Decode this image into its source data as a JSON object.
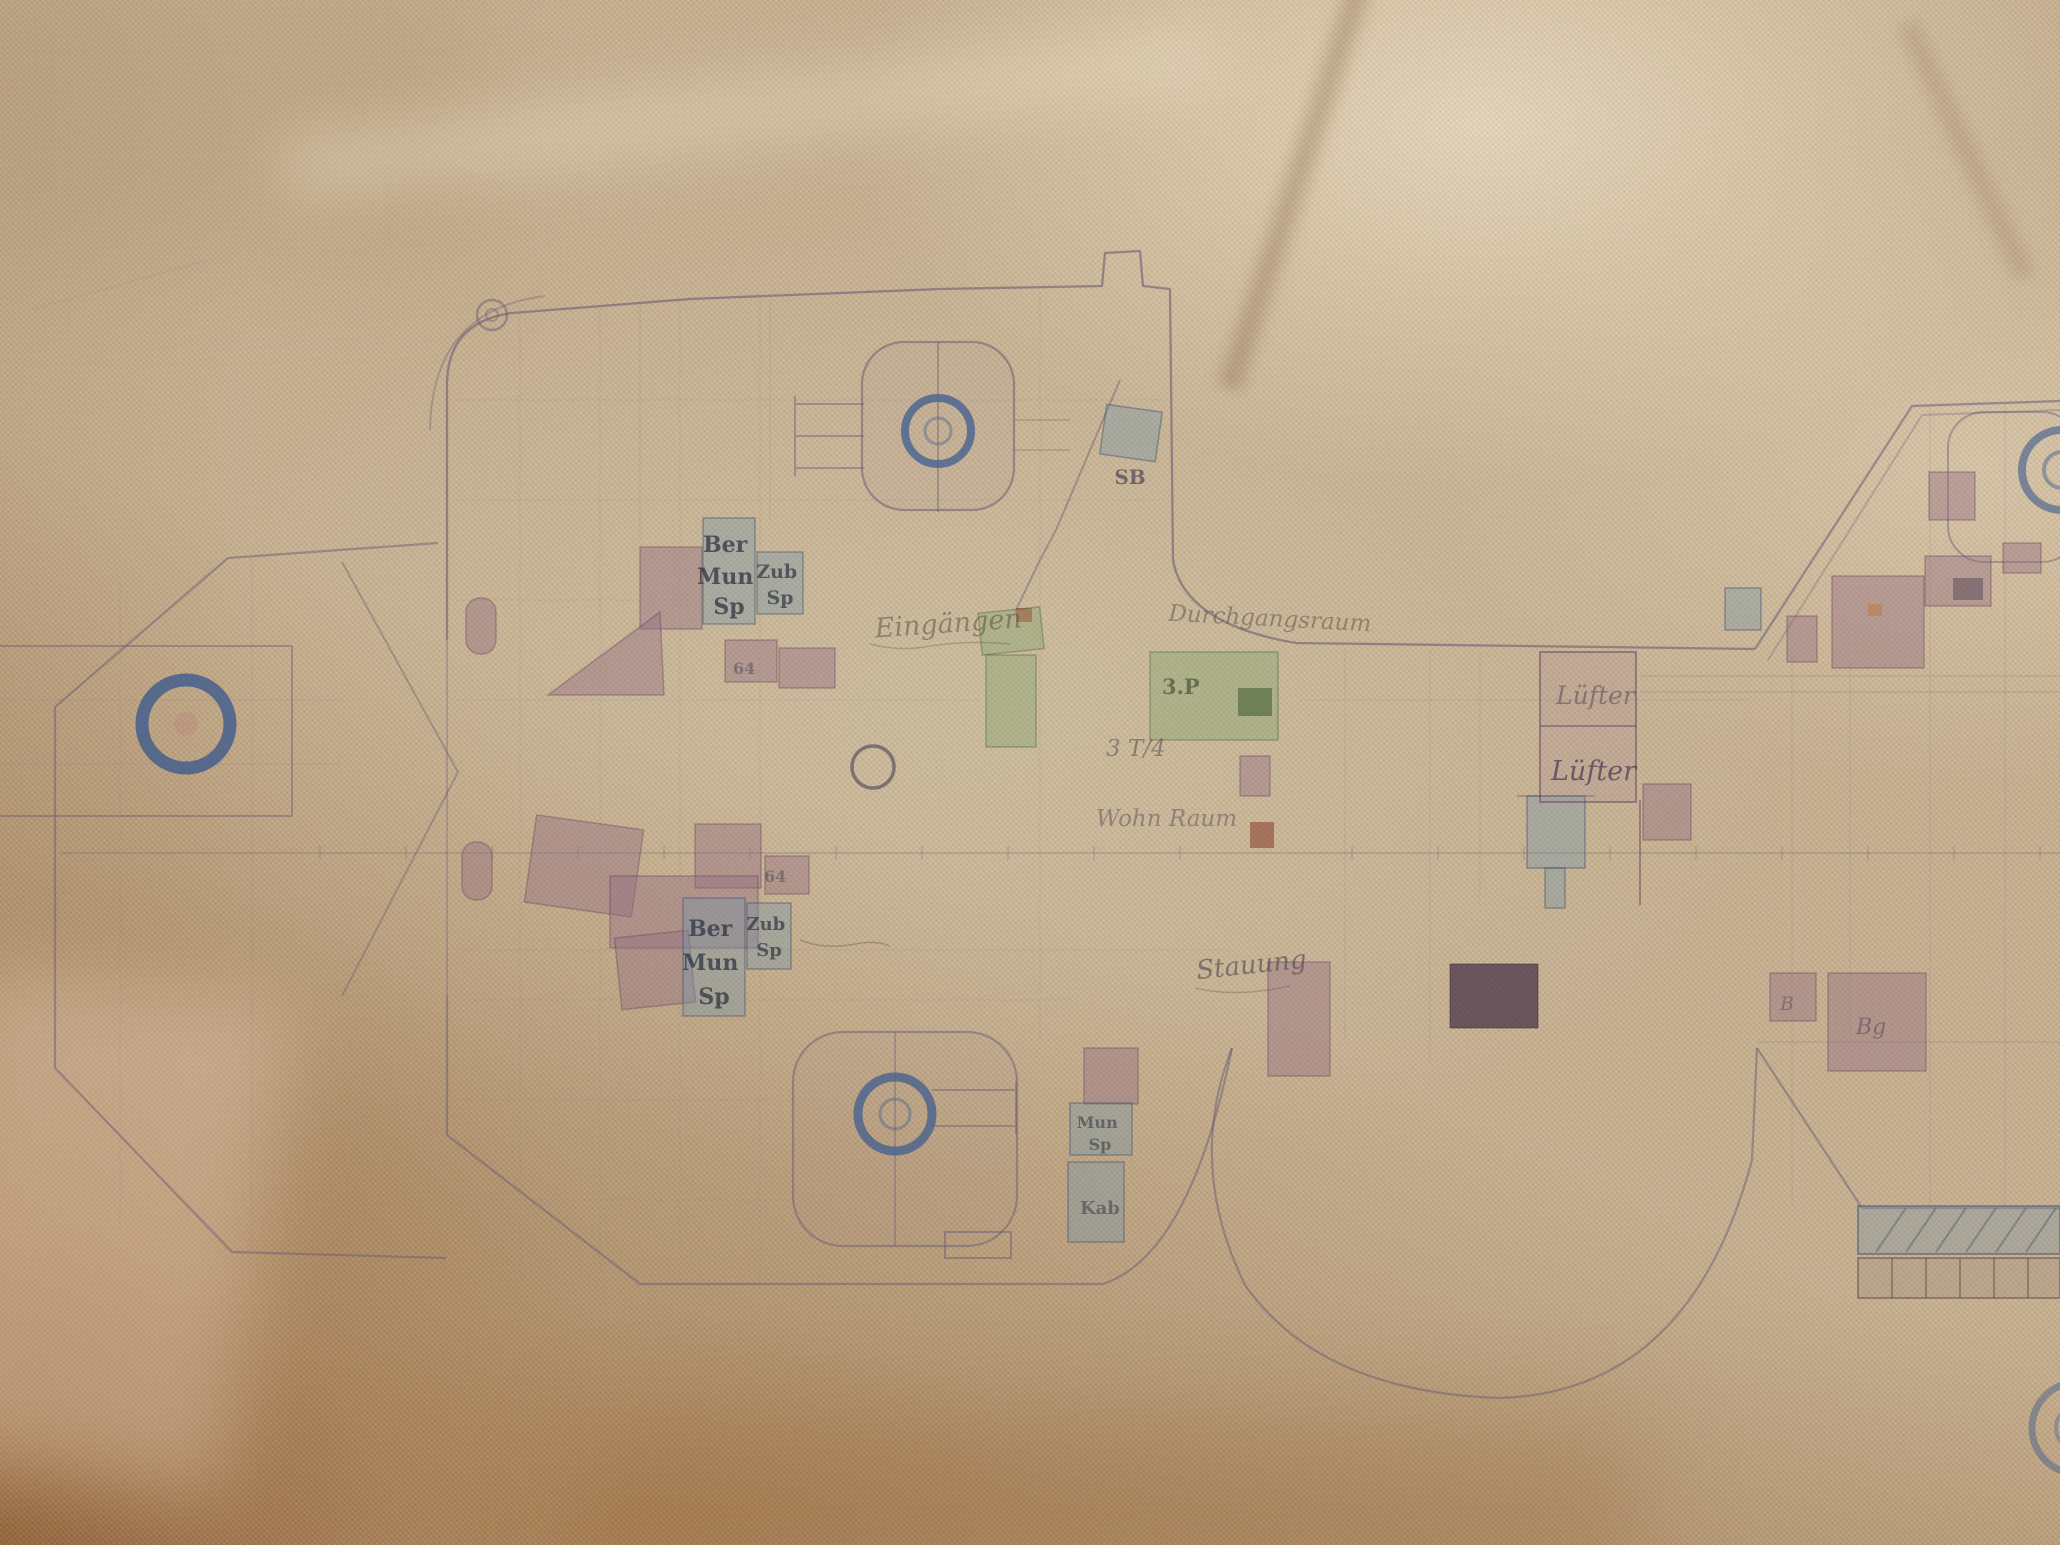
{
  "plan": {
    "labels": {
      "mun_fwd": {
        "lines": [
          "Ber",
          "Mun",
          "Sp"
        ]
      },
      "zub_fwd": {
        "lines": [
          "Zub",
          "Sp"
        ]
      },
      "sb": {
        "text": "SB"
      },
      "eingaengen": {
        "text": "Eingängen"
      },
      "durchgang": {
        "text": "Durchgangsraum"
      },
      "p3": {
        "text": "3.P"
      },
      "t34": {
        "text": "3 T/4"
      },
      "wohnraum": {
        "text": "Wohn Raum"
      },
      "mun_aft": {
        "lines": [
          "Ber",
          "Mun",
          "Sp"
        ]
      },
      "zub_aft": {
        "lines": [
          "Zub",
          "Sp"
        ]
      },
      "stauung": {
        "text": "Stauung"
      },
      "luefter_1": {
        "text": "Lüfter"
      },
      "luefter_2": {
        "text": "Lüfter"
      },
      "bg_mark": {
        "text": "Bg"
      },
      "b_mark": {
        "text": "B"
      },
      "n64_a": {
        "text": "64"
      },
      "n64_b": {
        "text": "64"
      },
      "kab": {
        "text": "Kab"
      },
      "mun_small": {
        "lines": [
          "Mun",
          "Sp"
        ]
      }
    },
    "palette": {
      "paper_tan": "#c6b091",
      "paper_light": "#e0d2b4",
      "shadow_brown": "#8f6a42",
      "ink_line": "#6a5d74",
      "ring_blue": "#3b5a8e",
      "room_mauve": "#966e84",
      "room_bluegray": "#7396aa",
      "room_green": "#82a56e",
      "ink_dark": "#2f3542",
      "accent_rust": "#8a4632"
    }
  }
}
